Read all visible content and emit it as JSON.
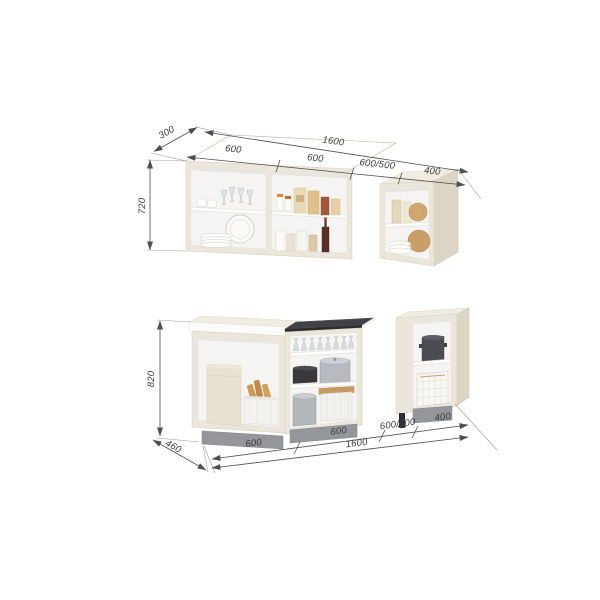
{
  "diagram": {
    "type": "kitchen-set-dimension-diagram",
    "upper": {
      "depth": "300",
      "height": "720",
      "total_width": "1600",
      "cab1_width": "600",
      "cab2_width": "600",
      "hood_gap": "600/500",
      "cab3_width": "400"
    },
    "lower": {
      "height": "820",
      "depth": "460",
      "cab1_width": "600",
      "cab2_width": "600",
      "total_width": "1600",
      "hood_gap": "600/500",
      "cab3_width": "400"
    },
    "colors": {
      "background": "#ffffff",
      "carcass": "#ebe5da",
      "carcass_side": "#dcd4c5",
      "interior": "#f5f4f2",
      "plinth": "#95969b",
      "hob": "#414046",
      "dim_line": "#4f4f4f",
      "dim_text": "#3b3b3b",
      "accent": "#a85c50"
    }
  }
}
